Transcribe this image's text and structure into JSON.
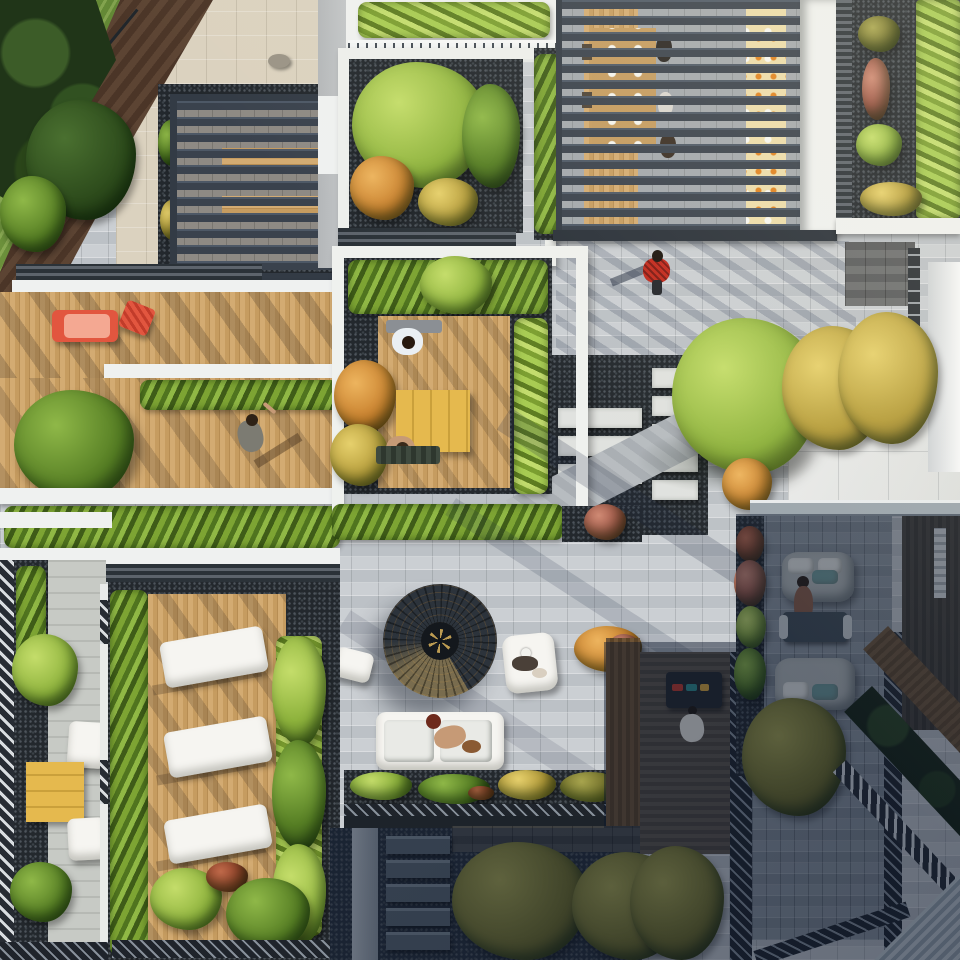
{
  "scene": {
    "title": "Aerial top-down view of modern rooftop terraces and courtyard gardens",
    "type": "architectural 3D rendering, photographic style",
    "view": "directly overhead (plan view)",
    "lighting": "low warm sun from upper right casting long diagonal shadows; lower-right quadrant in cool building shade",
    "setting": "multi-level residential rooftop amenity gardens with pergolas, timber decks, paver plazas, planted borders and outdoor furniture"
  },
  "palette": {
    "paver_light": "#cbcfd3",
    "paver_joint": "#bcc1c6",
    "stone_beige": "#dbd2bf",
    "gravel_dark": "#23282d",
    "pergola_slate": "#3a424d",
    "white_trim": "#eff1f0",
    "railing_white": "#f2f4f4",
    "forest_green": "#203518",
    "sofa_white": "#f6f5f1",
    "sofa_grey": "#b6bbba",
    "teal_cushion": "#6f9c9a",
    "red_furniture": "#e2563f",
    "coral_cushion": "#f4a892",
    "table_yellow": "#e5b94e",
    "skin_tone": "#c69a76",
    "fire_ring_dark": "#2c333b",
    "fire_ring_gold": "#bd9c52",
    "shade_blue": "rgba(17,30,54,0.34)"
  },
  "structures": [
    {
      "id": "pergola-top-left",
      "label": "dark slatted pergola over paver court"
    },
    {
      "id": "pergola-top-right",
      "label": "large dark slatted pergola over outdoor dining room and kitchen counter"
    },
    {
      "id": "fire-pit-pavilion",
      "label": "circular slatted pavilion with central planter"
    },
    {
      "id": "green-roof",
      "label": "sedum and grass green roof with gravel, top right"
    },
    {
      "id": "planter-terrace",
      "label": "white-edged planter terrace with lush trees"
    },
    {
      "id": "private-terrace",
      "label": "white parapet terrace with timber deck and dining table"
    },
    {
      "id": "stepping-stones",
      "label": "white slab stepping stones in dark gravel"
    },
    {
      "id": "staircase",
      "label": "five stone treads descending to lower garden"
    },
    {
      "id": "herringbone-path",
      "label": "light herringbone paver path, bottom right corner"
    },
    {
      "id": "timber-walkway",
      "label": "diagonal timber walkway, right edge"
    },
    {
      "id": "white-parapets",
      "label": "white parapet bands separating terrace levels"
    },
    {
      "id": "louvre-edges",
      "label": "dark louvred vent strips bordering terraces"
    }
  ],
  "furniture": [
    {
      "id": "red-lounger",
      "label": "red sun lounger with coral cushion plus tilted red deck chair",
      "location": "upper-left timber deck"
    },
    {
      "id": "white-loungers",
      "label": "three white sun loungers in a row",
      "location": "lower-left timber deck"
    },
    {
      "id": "white-sofa",
      "label": "white modular outdoor sofa",
      "location": "central plaza"
    },
    {
      "id": "white-armchair",
      "label": "white lounge armchair",
      "location": "central plaza"
    },
    {
      "id": "yellow-table-terrace",
      "label": "yellow plank dining table with benches",
      "location": "private center terrace"
    },
    {
      "id": "yellow-table-balcony",
      "label": "yellow table with two white benches",
      "location": "left balcony"
    },
    {
      "id": "grey-sofas",
      "label": "two curved grey sofas with coffee table",
      "location": "shaded right terrace"
    },
    {
      "id": "bbq-grill",
      "label": "barbecue grill with food",
      "location": "shaded dark deck"
    },
    {
      "id": "pergola-dining",
      "label": "long timber dining table with white plates and kitchen counter with fruit",
      "location": "under top-right pergola"
    }
  ],
  "people": [
    {
      "id": "walker-red",
      "label": "person in red plaid shirt walking across grey pavers"
    },
    {
      "id": "walker-deck",
      "label": "person in grey shirt walking on timber deck, one arm raised"
    },
    {
      "id": "diner-white-shirt",
      "label": "man in white t-shirt seated at yellow table"
    },
    {
      "id": "diner-shirtless",
      "label": "shirtless man seated opposite at yellow table"
    },
    {
      "id": "woman-sofa",
      "label": "red-haired woman lounging on white sofa with small dog"
    },
    {
      "id": "person-armchair",
      "label": "person in white cap in armchair with small dog"
    },
    {
      "id": "person-grey-sofa",
      "label": "person seated on curved grey sofa"
    },
    {
      "id": "person-bbq",
      "label": "person in white standing at barbecue"
    },
    {
      "id": "pergola-diners",
      "label": "group dining beneath the large slatted pergola"
    }
  ],
  "vegetation": [
    {
      "id": "forest-corner",
      "label": "dense dark green trees, top-left corner"
    },
    {
      "id": "lush-planter-trees",
      "label": "light green and orange trees in planter terrace"
    },
    {
      "id": "autumn-trees",
      "label": "yellow-green autumn canopies, mid right"
    },
    {
      "id": "olive-trees",
      "label": "olive-toned shaded trees, bottom"
    },
    {
      "id": "hedges",
      "label": "lime green hedge screens and borders"
    },
    {
      "id": "sedum-mat",
      "label": "bright green sedum mat on green roof"
    },
    {
      "id": "pink-grasses",
      "label": "pink ornamental grasses in gravel beds"
    }
  ]
}
